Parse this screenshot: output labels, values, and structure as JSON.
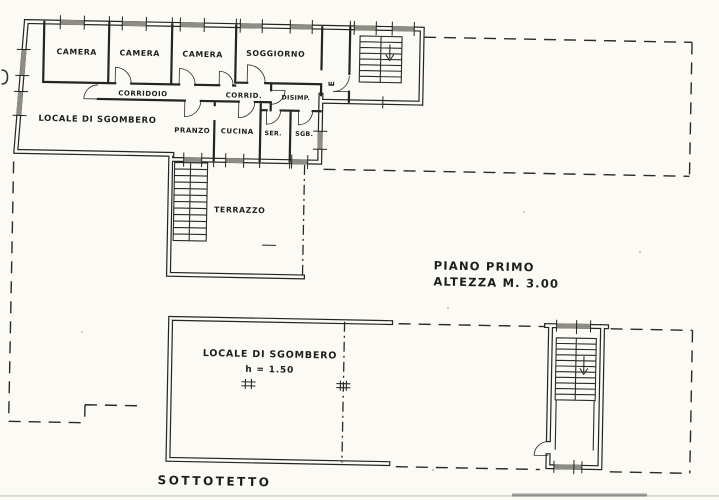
{
  "colors": {
    "paper": "#fbfaf5",
    "ink": "#242424",
    "window_fill": "#8d8d84"
  },
  "piano_primo": {
    "caption_line1": "PIANO PRIMO",
    "caption_line2": "ALTEZZA  M. 3.00",
    "entrance_label": "E",
    "rooms": [
      {
        "label": "CAMERA"
      },
      {
        "label": "CAMERA"
      },
      {
        "label": "CAMERA"
      },
      {
        "label": "SOGGIORNO"
      },
      {
        "label": "CORRIDOIO"
      },
      {
        "label": "CORRID."
      },
      {
        "label": "DISIMP."
      },
      {
        "label": "LOCALE DI SGOMBERO"
      },
      {
        "label": "PRANZO"
      },
      {
        "label": "CUCINA"
      },
      {
        "label": "SER."
      },
      {
        "label": "SGB."
      },
      {
        "label": "TERRAZZO"
      }
    ]
  },
  "sottotetto": {
    "caption": "SOTTOTETTO",
    "rooms": [
      {
        "label": "LOCALE DI SGOMBERO",
        "height_note": "h = 1.50"
      }
    ]
  },
  "icons": {
    "stairs_upper": "staircase-icon",
    "stairs_terrace": "staircase-icon",
    "stairs_sottotetto": "staircase-icon",
    "roof_window": "roof-window-icon"
  }
}
